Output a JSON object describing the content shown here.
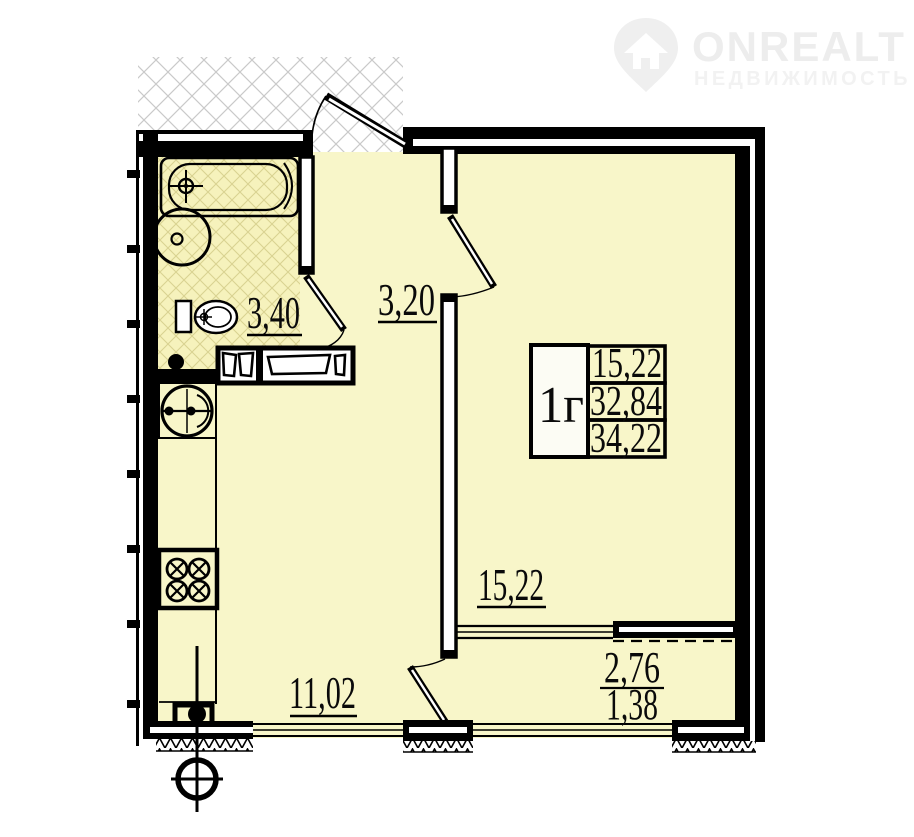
{
  "watermark": {
    "brand": "ONREALT",
    "subtitle": "НЕДВИЖИМОСТЬ"
  },
  "unit": {
    "type": "1г",
    "living_area": "15,22",
    "apartment_area": "32,84",
    "total_area": "34,22"
  },
  "rooms": {
    "bathroom": "3,40",
    "hallway": "3,20",
    "living_room": "15,22",
    "kitchen": "11,02",
    "balcony_full": "2,76",
    "balcony_counted": "1,38"
  },
  "colors": {
    "room_fill": "#F8F6C9",
    "bathroom_tile_line": "#D9D291",
    "wall": "#000000",
    "outside_hatch_line": "#c9c9c9",
    "watermark_gray": "#ededed"
  }
}
